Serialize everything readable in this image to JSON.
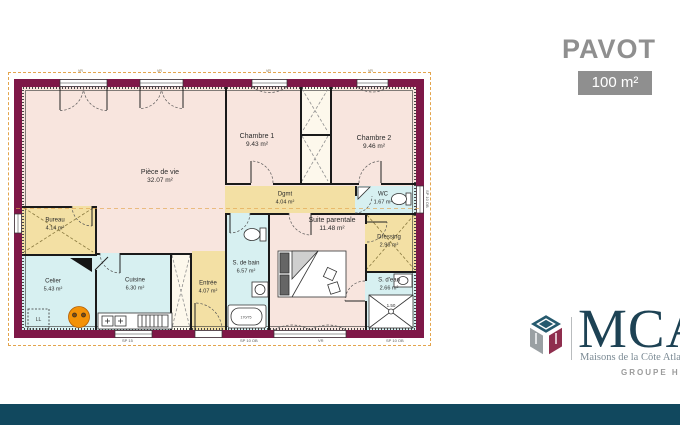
{
  "header": {
    "model_name": "PAVOT",
    "area_badge": "100 m²"
  },
  "branding": {
    "logo_acronym": "MCA",
    "logo_tagline": "Maisons de la Côte Atlantique",
    "logo_group": "GROUPE HEXAOM"
  },
  "plan": {
    "rooms": [
      {
        "name": "Pièce de vie",
        "area": "32.07 m²"
      },
      {
        "name": "Chambre 1",
        "area": "9.43 m²"
      },
      {
        "name": "Chambre 2",
        "area": "9.46 m²"
      },
      {
        "name": "Dgmt",
        "area": "4.04 m²"
      },
      {
        "name": "WC",
        "area": "1.67 m²"
      },
      {
        "name": "Bureau",
        "area": "4.14 m²"
      },
      {
        "name": "Celier",
        "area": "5.43 m²"
      },
      {
        "name": "Cuisine",
        "area": "6.30 m²"
      },
      {
        "name": "Entrée",
        "area": "4.07 m²"
      },
      {
        "name": "S. de bain",
        "area": "6.57 m²"
      },
      {
        "name": "Suite parentale",
        "area": "11.48 m²"
      },
      {
        "name": "Dressing",
        "area": "2.96 m²"
      },
      {
        "name": "S. d'eau",
        "area": "2.66 m²"
      }
    ],
    "annotations": {
      "washer": "LL",
      "shower_width": "1.50",
      "bathtub_size": "170/75",
      "bottom_dims": [
        "SP 15",
        "SP 10 OB",
        "VR",
        "SP 10 OB"
      ],
      "right_dim": "SP 10 OB",
      "window_marks": [
        "VR",
        "VR",
        "VR",
        "VR"
      ]
    },
    "colors": {
      "wall": "#7e1747",
      "day_rooms": "#f8e5de",
      "service_rooms": "#d7f0f1",
      "circulation_rooms": "#f3e0a4",
      "lot_outline_dash": "#e3a44c"
    }
  }
}
